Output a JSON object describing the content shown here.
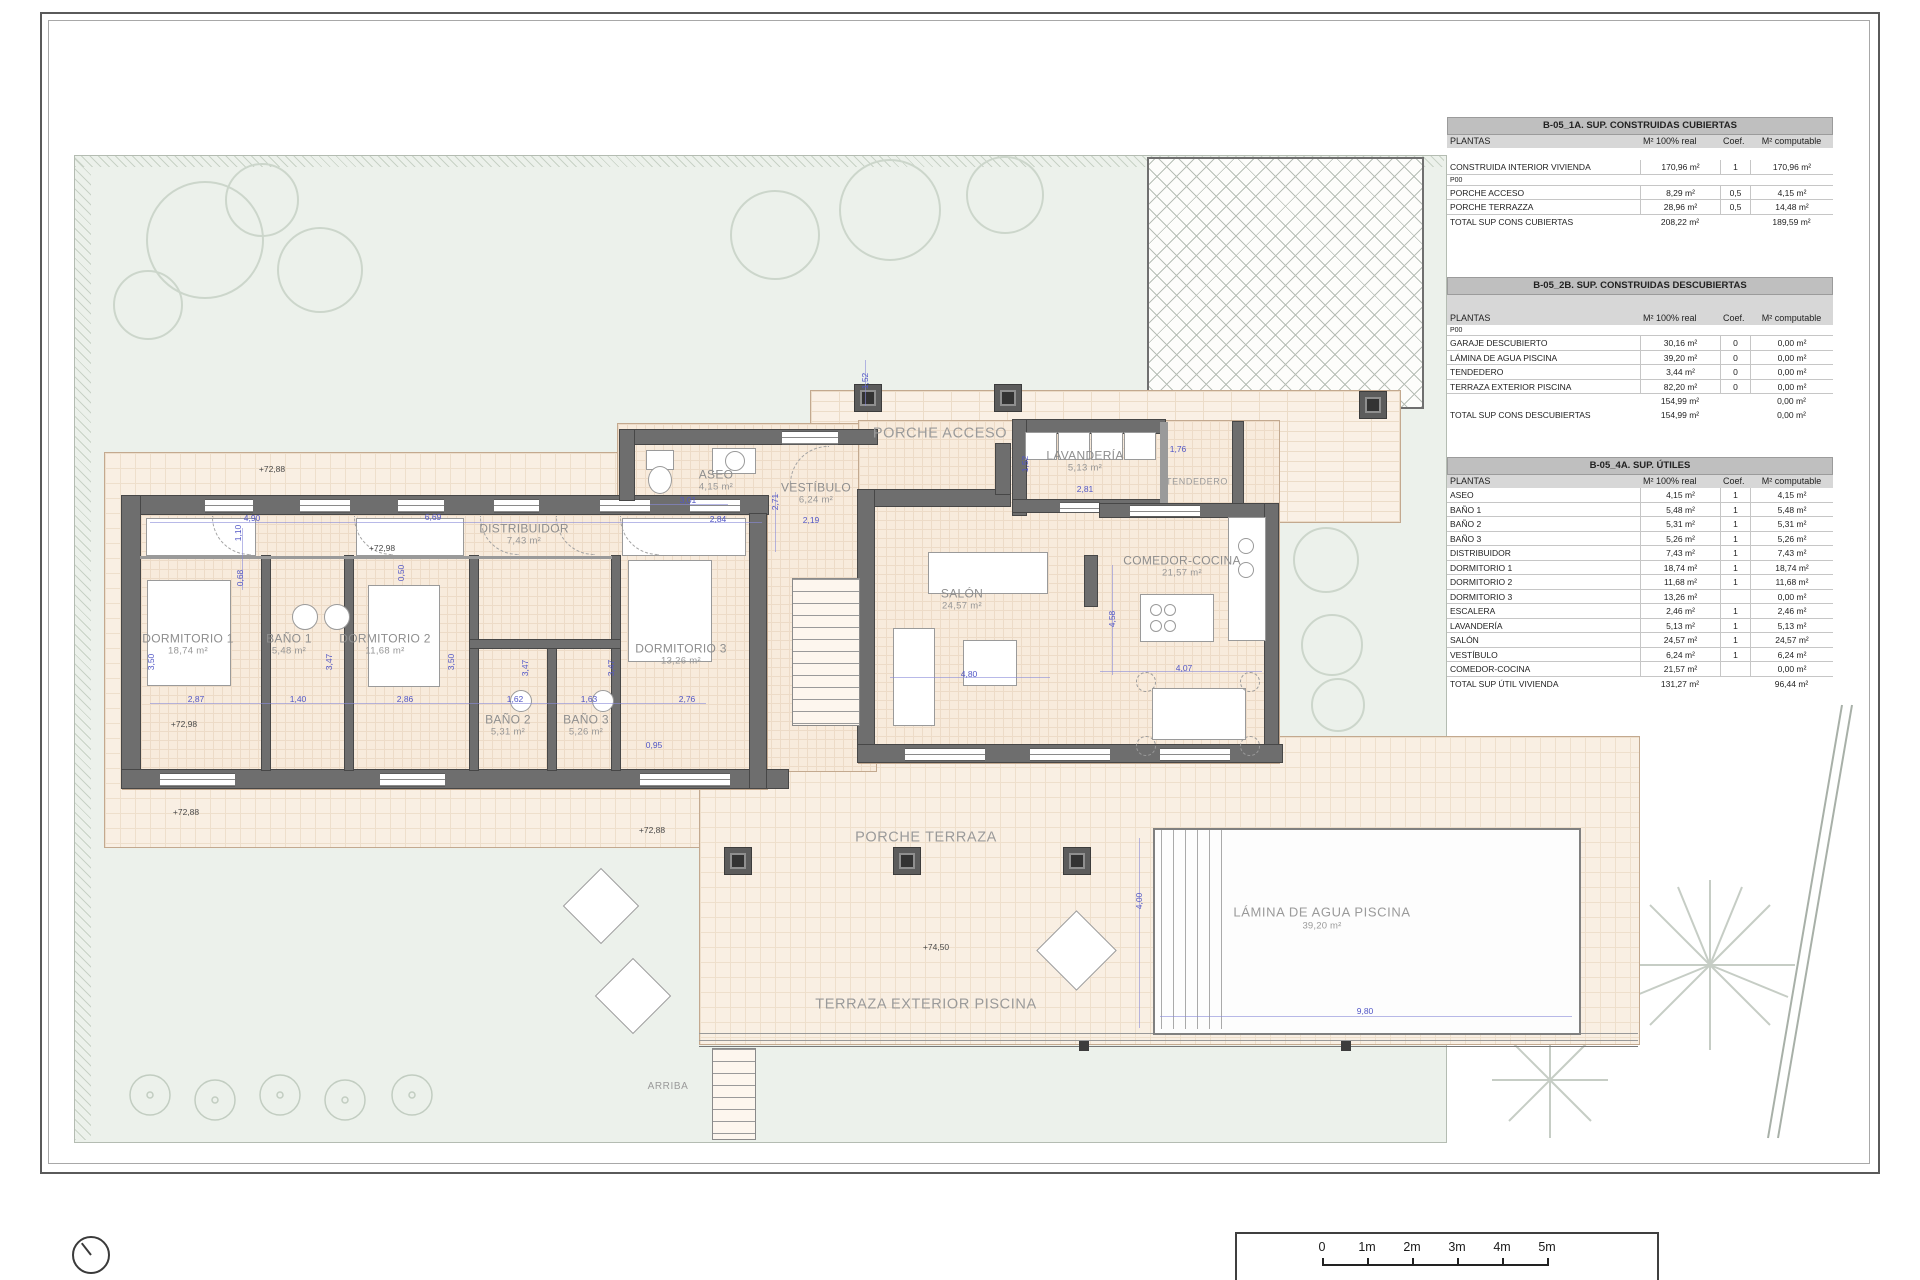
{
  "sheet": {
    "kind": "architectural floor plan"
  },
  "tables": [
    {
      "title": "B-05_1A. SUP. CONSTRUIDAS CUBIERTAS",
      "columns": [
        "PLANTAS",
        "M² 100% real",
        "Coef.",
        "M² computable"
      ],
      "tall_header": false,
      "rows": [
        {
          "type": "gap"
        },
        {
          "type": "data",
          "label": "CONSTRUIDA INTERIOR VIVIENDA",
          "real": "170,96 m²",
          "coef": "1",
          "comp": "170,96 m²"
        },
        {
          "type": "section",
          "label": "P00"
        },
        {
          "type": "data",
          "label": "PORCHE ACCESO",
          "real": "8,29 m²",
          "coef": "0,5",
          "comp": "4,15 m²"
        },
        {
          "type": "data",
          "label": "PORCHE TERRAZZA",
          "real": "28,96 m²",
          "coef": "0,5",
          "comp": "14,48 m²"
        },
        {
          "type": "total",
          "label": "TOTAL SUP CONS CUBIERTAS",
          "real": "208,22 m²",
          "coef": "",
          "comp": "189,59 m²"
        }
      ]
    },
    {
      "title": "B-05_2B. SUP. CONSTRUIDAS DESCUBIERTAS",
      "columns": [
        "PLANTAS",
        "M² 100% real",
        "Coef.",
        "M² computable"
      ],
      "tall_header": true,
      "rows": [
        {
          "type": "section",
          "label": "P00"
        },
        {
          "type": "data",
          "label": "GARAJE DESCUBIERTO",
          "real": "30,16 m²",
          "coef": "0",
          "comp": "0,00 m²"
        },
        {
          "type": "data",
          "label": "LÁMINA DE AGUA PISCINA",
          "real": "39,20 m²",
          "coef": "0",
          "comp": "0,00 m²"
        },
        {
          "type": "data",
          "label": "TENDEDERO",
          "real": "3,44 m²",
          "coef": "0",
          "comp": "0,00 m²"
        },
        {
          "type": "data",
          "label": "TERRAZA EXTERIOR PISCINA",
          "real": "82,20 m²",
          "coef": "0",
          "comp": "0,00 m²"
        },
        {
          "type": "total",
          "label": "",
          "real": "154,99 m²",
          "coef": "",
          "comp": "0,00 m²"
        },
        {
          "type": "total",
          "label": "TOTAL SUP CONS DESCUBIERTAS",
          "real": "154,99 m²",
          "coef": "",
          "comp": "0,00 m²"
        }
      ]
    },
    {
      "title": "B-05_4A. SUP. ÚTILES",
      "columns": [
        "PLANTAS",
        "M² 100% real",
        "Coef.",
        "M² computable"
      ],
      "tall_header": false,
      "rows": [
        {
          "type": "data",
          "label": "ASEO",
          "real": "4,15 m²",
          "coef": "1",
          "comp": "4,15 m²"
        },
        {
          "type": "data",
          "label": "BAÑO 1",
          "real": "5,48 m²",
          "coef": "1",
          "comp": "5,48 m²"
        },
        {
          "type": "data",
          "label": "BAÑO 2",
          "real": "5,31 m²",
          "coef": "1",
          "comp": "5,31 m²"
        },
        {
          "type": "data",
          "label": "BAÑO 3",
          "real": "5,26 m²",
          "coef": "1",
          "comp": "5,26 m²"
        },
        {
          "type": "data",
          "label": "DISTRIBUIDOR",
          "real": "7,43 m²",
          "coef": "1",
          "comp": "7,43 m²"
        },
        {
          "type": "data",
          "label": "DORMITORIO 1",
          "real": "18,74 m²",
          "coef": "1",
          "comp": "18,74 m²"
        },
        {
          "type": "data",
          "label": "DORMITORIO 2",
          "real": "11,68 m²",
          "coef": "1",
          "comp": "11,68 m²"
        },
        {
          "type": "data",
          "label": "DORMITORIO 3",
          "real": "13,26 m²",
          "coef": "",
          "comp": "0,00 m²"
        },
        {
          "type": "data",
          "label": "ESCALERA",
          "real": "2,46 m²",
          "coef": "1",
          "comp": "2,46 m²"
        },
        {
          "type": "data",
          "label": "LAVANDERÍA",
          "real": "5,13 m²",
          "coef": "1",
          "comp": "5,13 m²"
        },
        {
          "type": "data",
          "label": "SALÓN",
          "real": "24,57 m²",
          "coef": "1",
          "comp": "24,57 m²"
        },
        {
          "type": "data",
          "label": "VESTÍBULO",
          "real": "6,24 m²",
          "coef": "1",
          "comp": "6,24 m²"
        },
        {
          "type": "data",
          "label": "COMEDOR-COCINA",
          "real": "21,57 m²",
          "coef": "",
          "comp": "0,00 m²"
        },
        {
          "type": "total",
          "label": "TOTAL SUP ÚTIL VIVIENDA",
          "real": "131,27 m²",
          "coef": "",
          "comp": "96,44 m²"
        }
      ]
    }
  ],
  "plan": {
    "room_labels": [
      {
        "name": "DORMITORIO 1",
        "area": "18,74 m²",
        "x": 188,
        "y": 645
      },
      {
        "name": "BAÑO 1",
        "area": "5,48 m²",
        "x": 289,
        "y": 645
      },
      {
        "name": "DORMITORIO 2",
        "area": "11,68 m²",
        "x": 385,
        "y": 645
      },
      {
        "name": "BAÑO 2",
        "area": "5,31 m²",
        "x": 508,
        "y": 726
      },
      {
        "name": "BAÑO 3",
        "area": "5,26 m²",
        "x": 586,
        "y": 726
      },
      {
        "name": "DORMITORIO 3",
        "area": "13,26 m²",
        "x": 681,
        "y": 655
      },
      {
        "name": "DISTRIBUIDOR",
        "area": "7,43 m²",
        "x": 524,
        "y": 535
      },
      {
        "name": "ASEO",
        "area": "4,15 m²",
        "x": 716,
        "y": 481
      },
      {
        "name": "VESTÍBULO",
        "area": "6,24 m²",
        "x": 816,
        "y": 494
      },
      {
        "name": "LAVANDERÍA",
        "area": "5,13 m²",
        "x": 1085,
        "y": 462
      },
      {
        "name": "COMEDOR-COCINA",
        "area": "21,57 m²",
        "x": 1182,
        "y": 567
      },
      {
        "name": "SALÓN",
        "area": "24,57 m²",
        "x": 962,
        "y": 600
      }
    ],
    "zone_labels": [
      {
        "name": "PORCHE ACCESO",
        "x": 940,
        "y": 434,
        "s": 14.5
      },
      {
        "name": "PORCHE TERRAZA",
        "x": 926,
        "y": 838,
        "s": 14.5
      },
      {
        "name": "TERRAZA EXTERIOR PISCINA",
        "x": 926,
        "y": 1005,
        "s": 14.5
      },
      {
        "name": "LÁMINA DE AGUA PISCINA",
        "area": "39,20 m²",
        "x": 1322,
        "y": 918,
        "s": 13
      },
      {
        "name": "TENDEDERO",
        "x": 1197,
        "y": 482,
        "s": 9
      },
      {
        "name": "ARRIBA",
        "x": 668,
        "y": 1087,
        "s": 10
      }
    ],
    "level_labels": [
      {
        "text": "+72,88",
        "x": 272,
        "y": 469
      },
      {
        "text": "+72,98",
        "x": 382,
        "y": 548
      },
      {
        "text": "+72,98",
        "x": 184,
        "y": 724
      },
      {
        "text": "+72,88",
        "x": 186,
        "y": 812
      },
      {
        "text": "+72,88",
        "x": 652,
        "y": 830
      },
      {
        "text": "+74,50",
        "x": 936,
        "y": 947
      }
    ],
    "dimensions": [
      {
        "t": "4,90",
        "x": 252,
        "y": 518
      },
      {
        "t": "6,69",
        "x": 433,
        "y": 517
      },
      {
        "t": "3,01",
        "x": 688,
        "y": 500
      },
      {
        "t": "2,84",
        "x": 718,
        "y": 519
      },
      {
        "t": "2,19",
        "x": 811,
        "y": 520
      },
      {
        "t": "2,87",
        "x": 196,
        "y": 699
      },
      {
        "t": "1,40",
        "x": 298,
        "y": 699
      },
      {
        "t": "2,86",
        "x": 405,
        "y": 699
      },
      {
        "t": "1,62",
        "x": 515,
        "y": 699
      },
      {
        "t": "1,63",
        "x": 589,
        "y": 699
      },
      {
        "t": "2,76",
        "x": 687,
        "y": 699
      },
      {
        "t": "0,95",
        "x": 654,
        "y": 745
      },
      {
        "t": "2,81",
        "x": 1085,
        "y": 489
      },
      {
        "t": "1,76",
        "x": 1178,
        "y": 449
      },
      {
        "t": "4,80",
        "x": 969,
        "y": 674
      },
      {
        "t": "4,07",
        "x": 1184,
        "y": 668
      },
      {
        "t": "9,80",
        "x": 1365,
        "y": 1011
      },
      {
        "t": "1,10",
        "x": 238,
        "y": 533,
        "v": 1
      },
      {
        "t": "0,68",
        "x": 240,
        "y": 578,
        "v": 1
      },
      {
        "t": "3,50",
        "x": 151,
        "y": 662,
        "v": 1
      },
      {
        "t": "3,47",
        "x": 329,
        "y": 662,
        "v": 1
      },
      {
        "t": "3,50",
        "x": 451,
        "y": 662,
        "v": 1
      },
      {
        "t": "3,47",
        "x": 525,
        "y": 668,
        "v": 1
      },
      {
        "t": "3,47",
        "x": 611,
        "y": 668,
        "v": 1
      },
      {
        "t": "0,50",
        "x": 401,
        "y": 573,
        "v": 1
      },
      {
        "t": "1,52",
        "x": 865,
        "y": 381,
        "v": 1
      },
      {
        "t": "2,71",
        "x": 775,
        "y": 502,
        "v": 1
      },
      {
        "t": "1,52",
        "x": 1025,
        "y": 464,
        "v": 1
      },
      {
        "t": "4,58",
        "x": 1112,
        "y": 619,
        "v": 1
      },
      {
        "t": "4,00",
        "x": 1139,
        "y": 901,
        "v": 1
      }
    ]
  },
  "scale_bar": {
    "labels": [
      "0",
      "1m",
      "2m",
      "3m",
      "4m",
      "5m"
    ]
  },
  "colors": {
    "wall": "#6e6e6e",
    "floor": "#f8ebdc",
    "garden": "#ecf1eb",
    "dimension": "#5156c6",
    "room_label": "#8e8e8e",
    "table_title_bg": "#bfbfbf",
    "table_header_bg": "#d7d7d7"
  }
}
